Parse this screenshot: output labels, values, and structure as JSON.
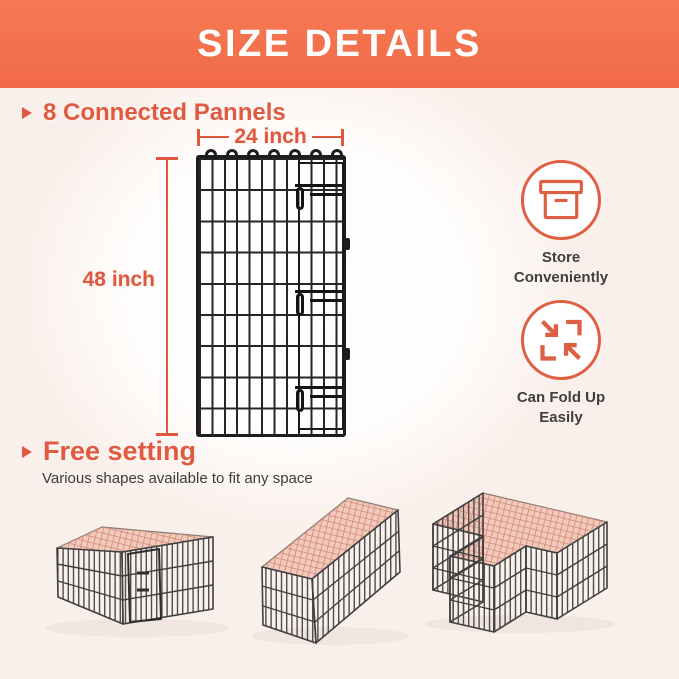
{
  "header": {
    "title": "SIZE DETAILS"
  },
  "colors": {
    "header_bg": "#F2714D",
    "accent_orange": "#E05A41",
    "wire_black": "#1D1D1D",
    "mesh_pink": "#F0BFAF",
    "page_background": "#FAF0EB"
  },
  "panel_section": {
    "heading": "8 Connected Pannels",
    "width_label": "24 inch",
    "height_label": "48 inch"
  },
  "features": [
    {
      "icon": "storage-box-icon",
      "lines": [
        "Store",
        "Conveniently"
      ]
    },
    {
      "icon": "fold-arrows-icon",
      "lines": [
        "Can Fold Up",
        "Easily"
      ]
    }
  ],
  "shapes_section": {
    "heading": "Free setting",
    "subtext": "Various shapes available to fit any space",
    "illustrations": [
      "square-pen",
      "rectangle-pen",
      "l-shaped-pen"
    ]
  }
}
